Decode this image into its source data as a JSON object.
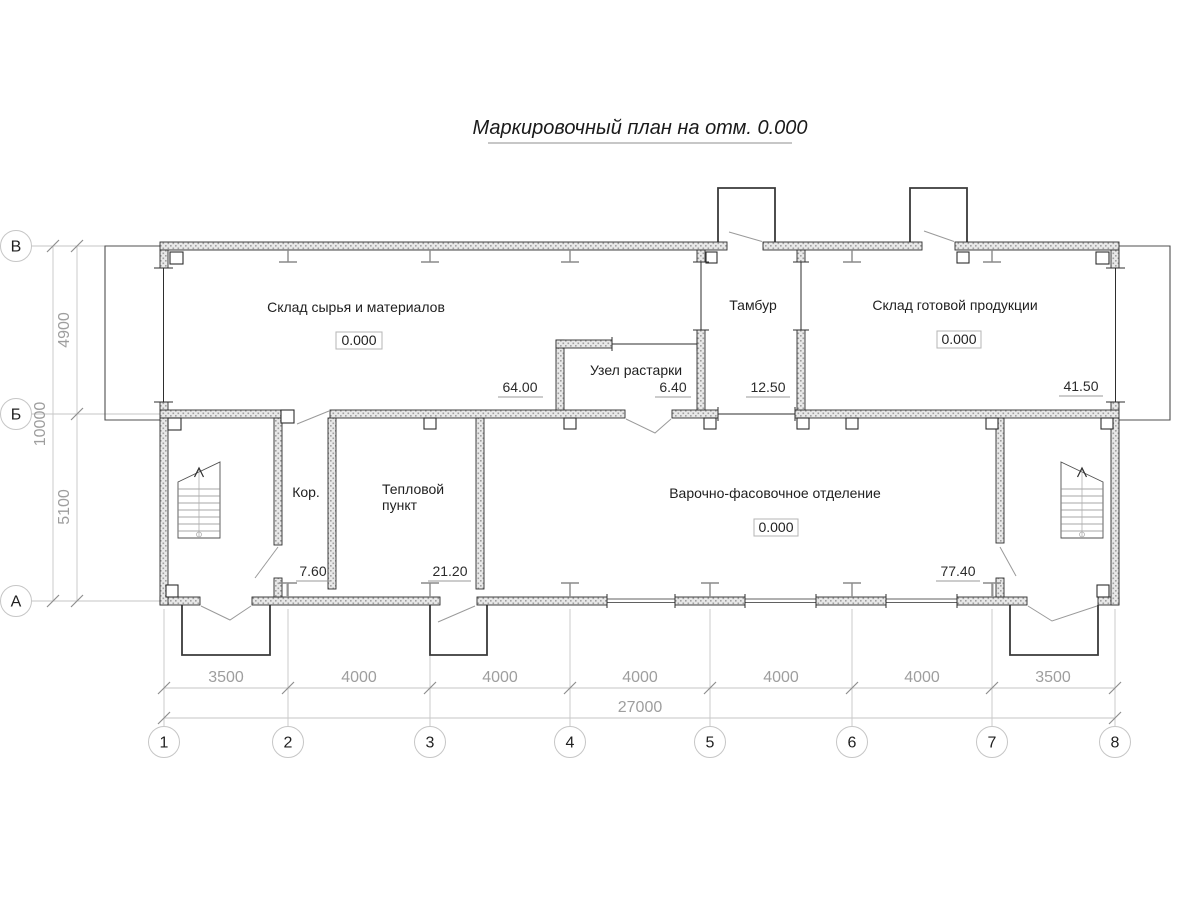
{
  "title": "Маркировочный план на отм. 0.000",
  "rooms": {
    "raw_materials": {
      "name": "Склад сырья и материалов",
      "elevation": "0.000",
      "area": "64.00"
    },
    "unpacking": {
      "name": "Узел растарки",
      "area": "6.40"
    },
    "vestibule": {
      "name": "Тамбур",
      "area": "12.50"
    },
    "finished_goods": {
      "name": "Склад готовой продукции",
      "elevation": "0.000",
      "area": "41.50"
    },
    "corridor": {
      "name": "Кор.",
      "area": "7.60"
    },
    "heat_point": {
      "name_line1": "Тепловой",
      "name_line2": "пункт",
      "area": "21.20"
    },
    "cooking_packing": {
      "name": "Варочно-фасовочное отделение",
      "elevation": "0.000",
      "area": "77.40"
    }
  },
  "axes": {
    "bottom": [
      "1",
      "2",
      "3",
      "4",
      "5",
      "6",
      "7",
      "8"
    ],
    "left": [
      "В",
      "Б",
      "А"
    ]
  },
  "dims": {
    "bottom": [
      "3500",
      "4000",
      "4000",
      "4000",
      "4000",
      "4000",
      "3500"
    ],
    "bottom_total": "27000",
    "left": [
      "4900",
      "5100"
    ],
    "left_total": "10000"
  },
  "colors": {
    "drawing_line": "#2e2e2e",
    "dimension_gray": "#9e9e9e",
    "wall_fill": "#e8e8e8",
    "background": "#ffffff"
  }
}
